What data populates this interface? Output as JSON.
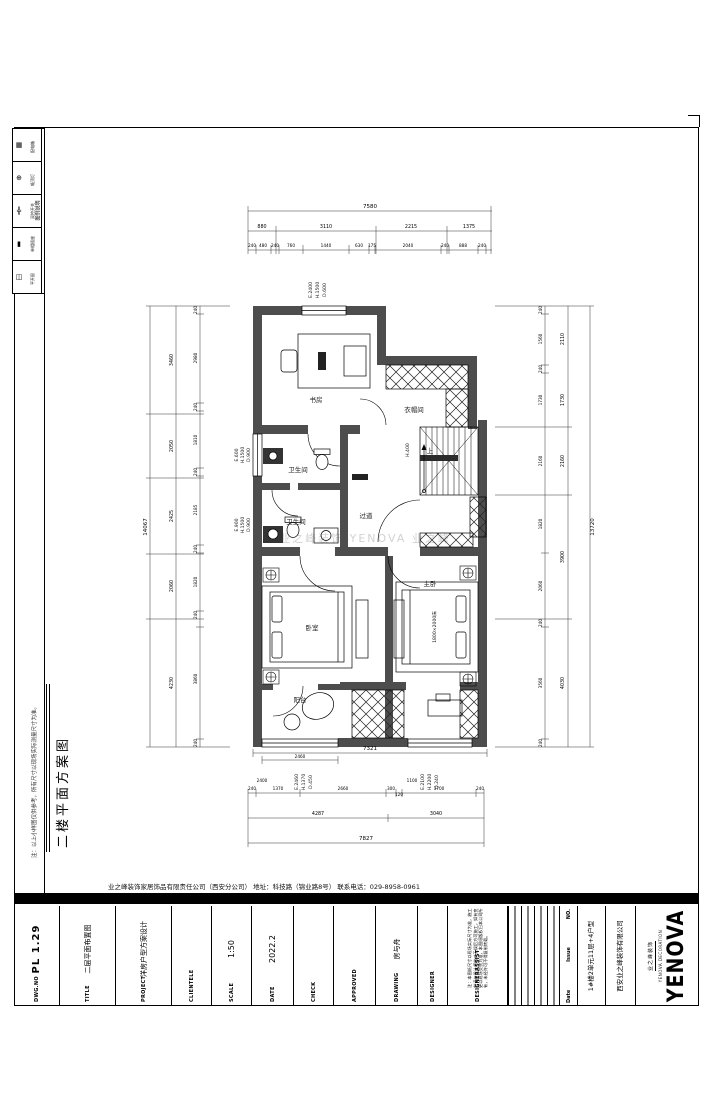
{
  "legend": {
    "title": "图例说明",
    "rows": [
      {
        "sym": "▦",
        "label": "配电箱"
      },
      {
        "sym": "⊕",
        "label": "吸顶灯"
      },
      {
        "sym": "╬",
        "label": "双控开关"
      },
      {
        "sym": "▮",
        "label": "单相插座"
      },
      {
        "sym": "◫",
        "label": "平开窗"
      }
    ]
  },
  "left_margin": {
    "note": "注：以上小样图仅供参考，所有尺寸以现场实际测量尺寸为准。",
    "title": "二楼平面方案图"
  },
  "watermark": "业之峰装饰 YENOVA 业之峰",
  "plan": {
    "rooms": {
      "study": "书房",
      "cloak": "衣帽间",
      "bath1": "卫生间",
      "bath2": "卫生间",
      "hall": "过道",
      "bed1": "卧室",
      "bed2": "主卧",
      "balcony": "阳台",
      "stair_up": "上",
      "stair_h": "H.400",
      "bed_size": "1800×2000床"
    },
    "annots": {
      "win_top": [
        "E.2400",
        "H.1500",
        "D.600"
      ],
      "win_left1": [
        "E.600",
        "H.1500",
        "D.900"
      ],
      "win_left2": [
        "E.900",
        "H.1500",
        "D.900"
      ],
      "win_bot1": [
        "E.2460",
        "H.1370",
        "D.450"
      ],
      "win_bot2": [
        "E.2100",
        "H.2200",
        "D.240"
      ]
    },
    "dims": {
      "top_total": "7580",
      "top_mid": [
        "880",
        "3110",
        "2215",
        "1375"
      ],
      "top_inner": [
        "240",
        "480",
        "240",
        "760",
        "1440",
        "630",
        "175",
        "2040",
        "240",
        "888",
        "240"
      ],
      "bot_plan": "7321",
      "bot_balcony": "2460",
      "bot_inner": [
        "240",
        "1370",
        "2660",
        "300",
        "120",
        "3700",
        "240"
      ],
      "bot_marks": [
        "2400",
        "1100"
      ],
      "bot_mid": [
        "4287",
        "3040"
      ],
      "bot_total": "7827",
      "left_total": "14067",
      "left_mid": [
        "3460",
        "2050",
        "2425",
        "2060",
        "4230"
      ],
      "left_inner": [
        "240",
        "2980",
        "240",
        "1810",
        "240",
        "2185",
        "240",
        "1820",
        "240",
        "3860",
        "240"
      ],
      "right_inner": [
        "240",
        "1560",
        "240",
        "1730",
        "2160",
        "1820",
        "2060",
        "240",
        "3560",
        "240"
      ],
      "right_mid": [
        "2110",
        "1730",
        "2160",
        "3900",
        "4030"
      ],
      "right_total": "13720"
    }
  },
  "footer": {
    "company_line": "业之峰装饰家居饰品有限责任公司（西安分公司）      地址：科技路（锦业路8号）      联系电话：029-8958-0961",
    "fields": [
      {
        "label": "DWG.NO",
        "value": "PL 1.29"
      },
      {
        "label": "TITLE",
        "value": "二层平面布置图"
      },
      {
        "label": "PROJECT",
        "value": "洋房户型方案设计"
      },
      {
        "label": "CLIENTELE",
        "value": ""
      },
      {
        "label": "SCALE",
        "value": "1:50"
      },
      {
        "label": "DATE",
        "value": "2022.2"
      },
      {
        "label": "CHECK",
        "value": ""
      },
      {
        "label": "APPROVED",
        "value": ""
      },
      {
        "label": "DRAWING",
        "value": "房与舟"
      },
      {
        "label": "DESIGNER",
        "value": ""
      },
      {
        "label": "DESIGNERASSIST",
        "value": ""
      }
    ],
    "designer_note": "注：本图纸尺寸以现场实际尺寸为准，施工前请与设计师核对无误后方可施工，如有变更以现场交底为准，本图纸版权归本公司所有，未经许可不得复制转载。",
    "revision": {
      "headers": [
        "NO.",
        "Issue",
        "Date"
      ]
    },
    "project_name": "1#楼2单元11层+4户型",
    "company_name": "西安业之峰装饰有限公司",
    "logo": {
      "en": "YENOVA",
      "cn": "业之峰装饰",
      "sub": "YENOVA DECORATION"
    }
  }
}
